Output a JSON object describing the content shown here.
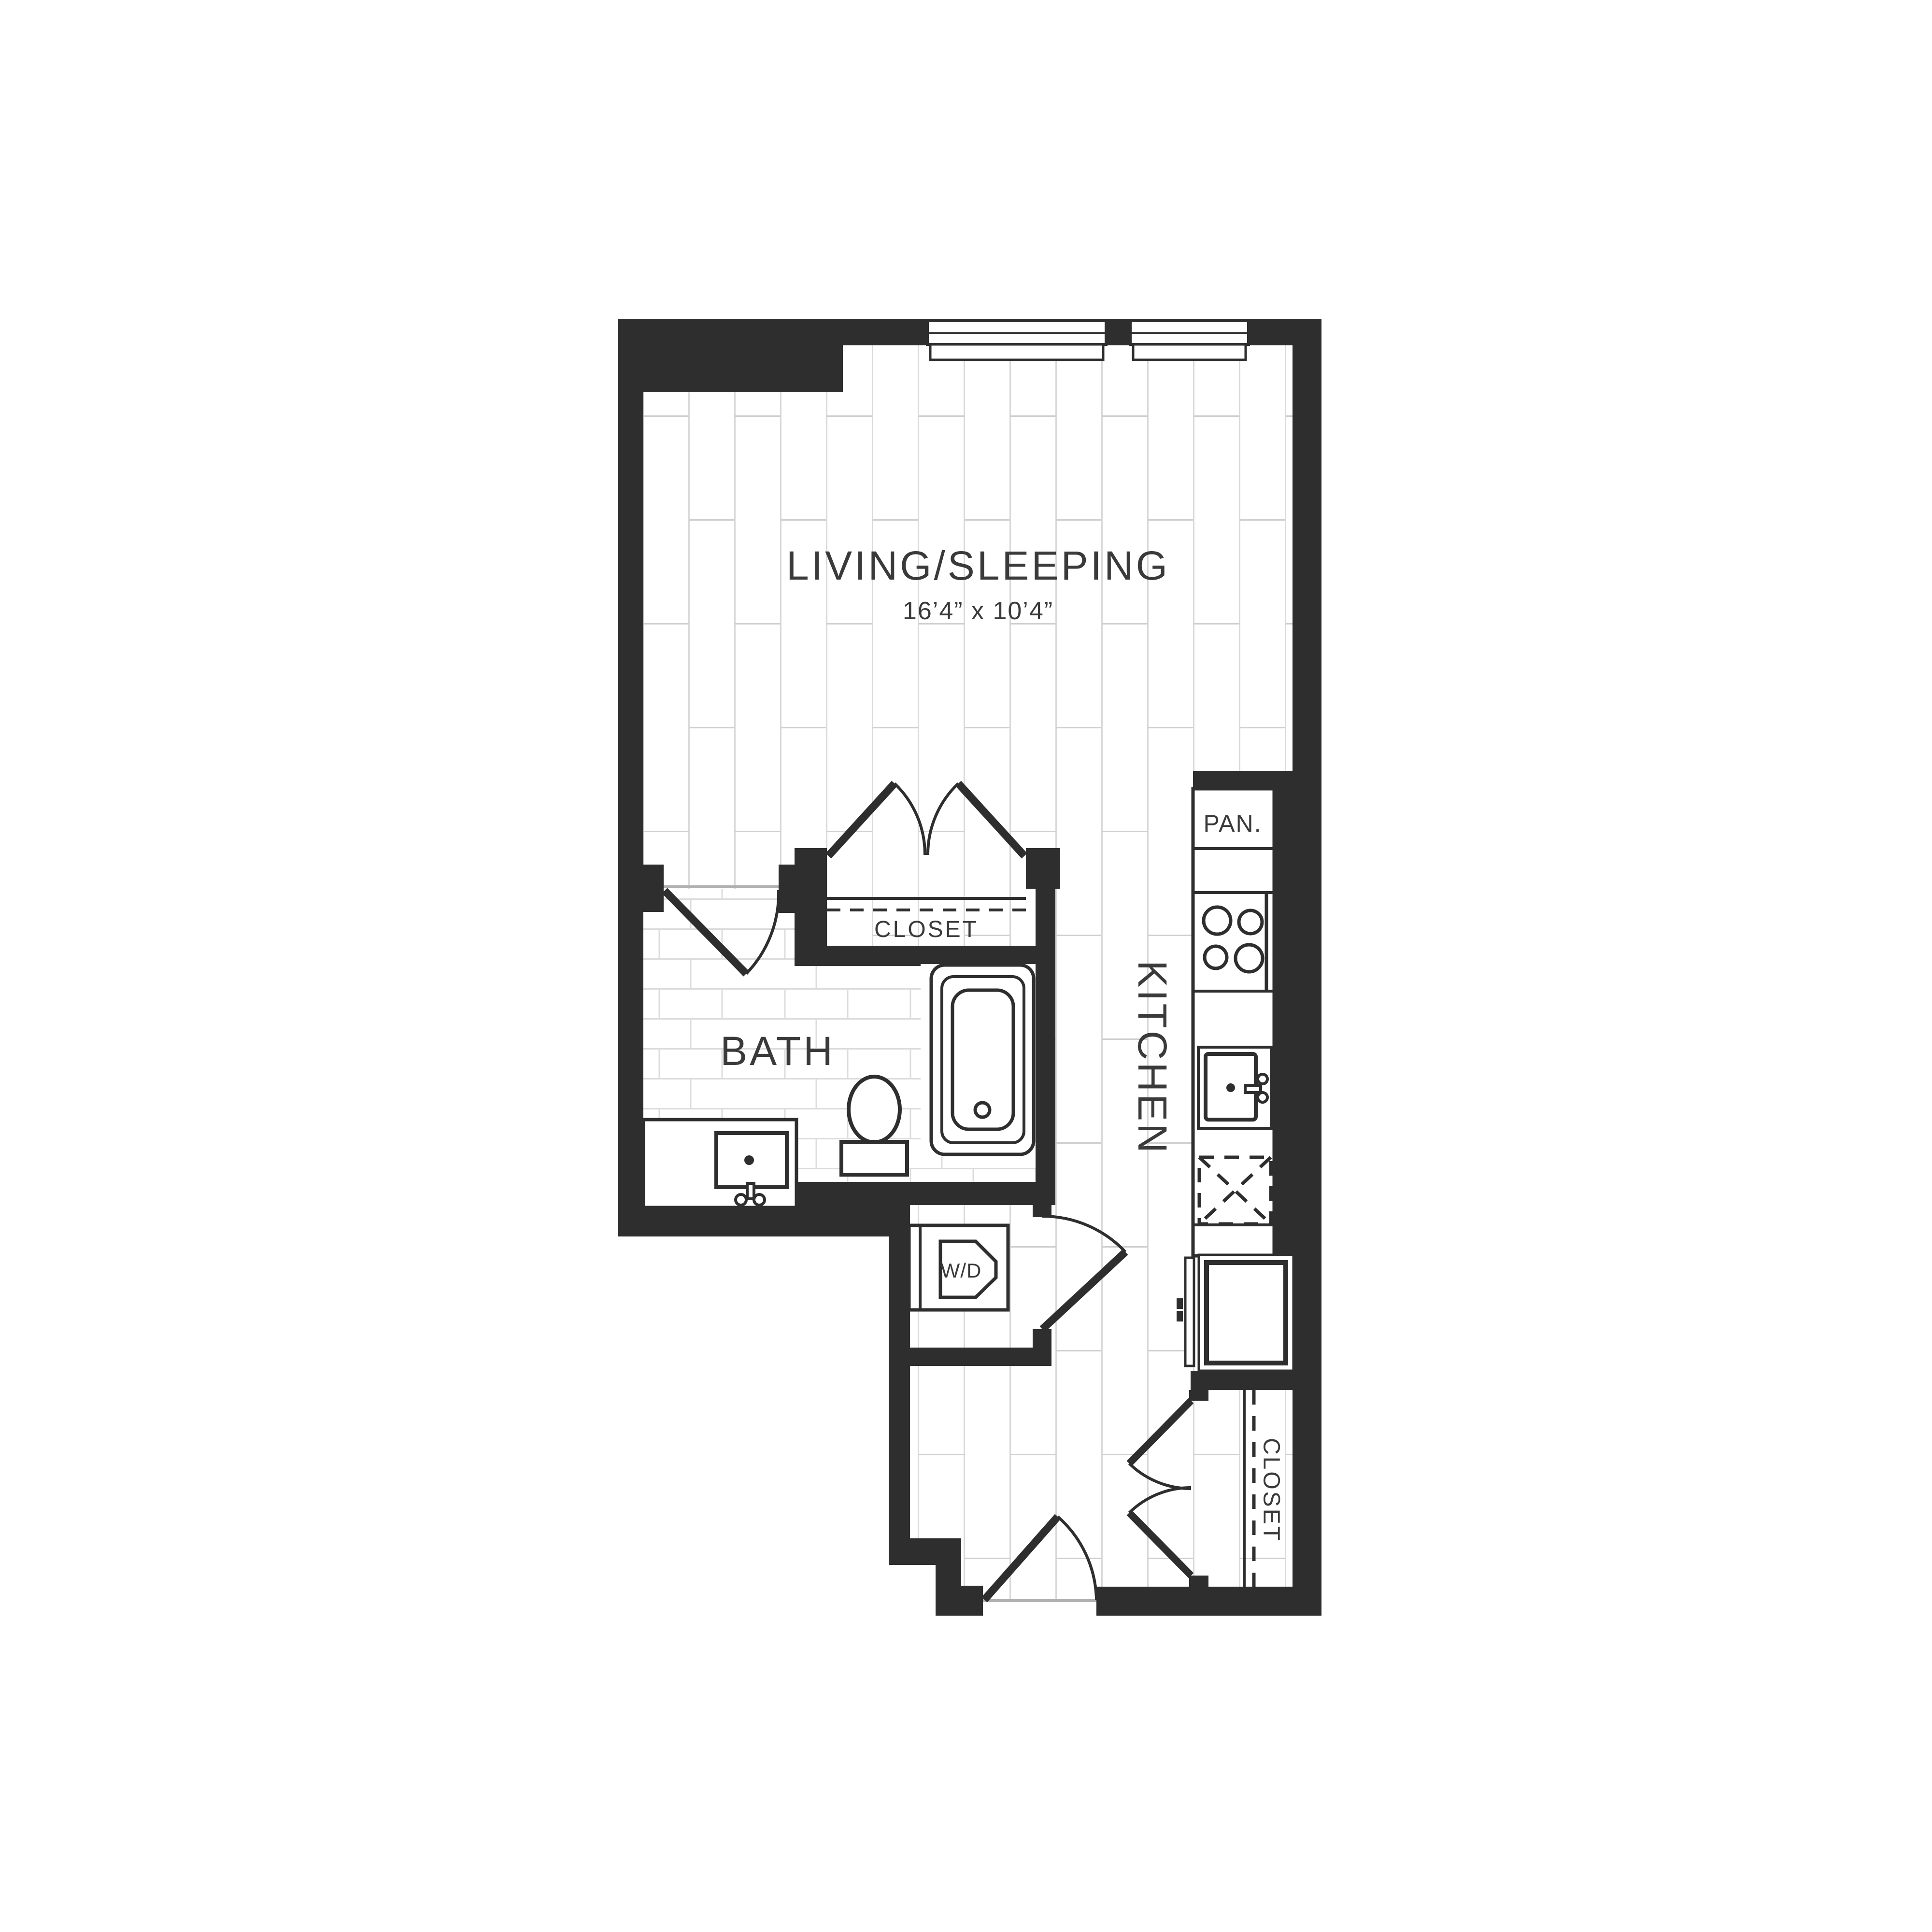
{
  "plan": {
    "title": "Studio apartment floor plan",
    "rooms": {
      "living": {
        "label": "LIVING/SLEEPING",
        "dimensions": "16’4” x 10’4”"
      },
      "bath": {
        "label": "BATH"
      },
      "kitchen": {
        "label": "KITCHEN"
      },
      "pantry": {
        "label": "PAN."
      },
      "closet_upper": {
        "label": "CLOSET"
      },
      "closet_entry": {
        "label": "CLOSET"
      },
      "laundry": {
        "label": "W/D"
      }
    },
    "fixtures": [
      "window",
      "window",
      "double-closet-doors",
      "hinged-door-bath",
      "bathtub",
      "toilet",
      "vanity-sink",
      "pantry-cabinet",
      "stove-burners",
      "kitchen-sink",
      "dishwasher",
      "refrigerator",
      "washer-dryer",
      "hinged-door-laundry",
      "entry-door",
      "double-closet-doors"
    ],
    "colors": {
      "wall": "#2e2e2e",
      "plank_line": "#d9d9d9",
      "tile_line": "#dcdcdc",
      "threshold": "#b0b0b0",
      "label_text": "#3a3a3a",
      "background": "#ffffff"
    }
  }
}
